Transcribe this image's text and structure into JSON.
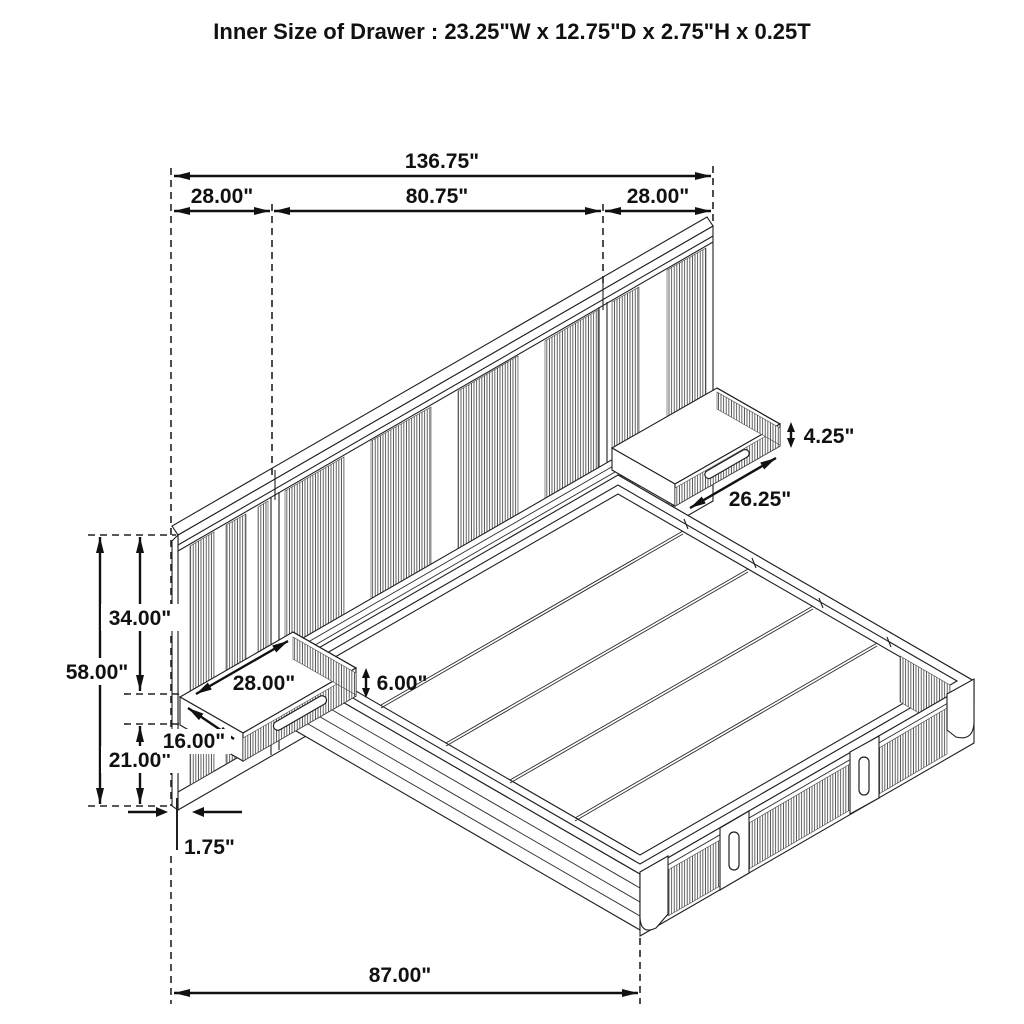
{
  "title": "Inner Size of Drawer : 23.25\"W x 12.75\"D x 2.75\"H x 0.25T",
  "dims": {
    "total_width": "136.75\"",
    "left_section": "28.00\"",
    "center_section": "80.75\"",
    "right_section": "28.00\"",
    "wall_height": "58.00\"",
    "wall_upper": "34.00\"",
    "wall_lower": "21.00\"",
    "panel_thickness": "1.75\"",
    "bed_span": "87.00\"",
    "left_shelf_width": "28.00\"",
    "left_shelf_depth": "16.00\"",
    "left_shelf_height": "6.00\"",
    "right_shelf_height": "4.25\"",
    "right_shelf_front": "26.25\""
  }
}
